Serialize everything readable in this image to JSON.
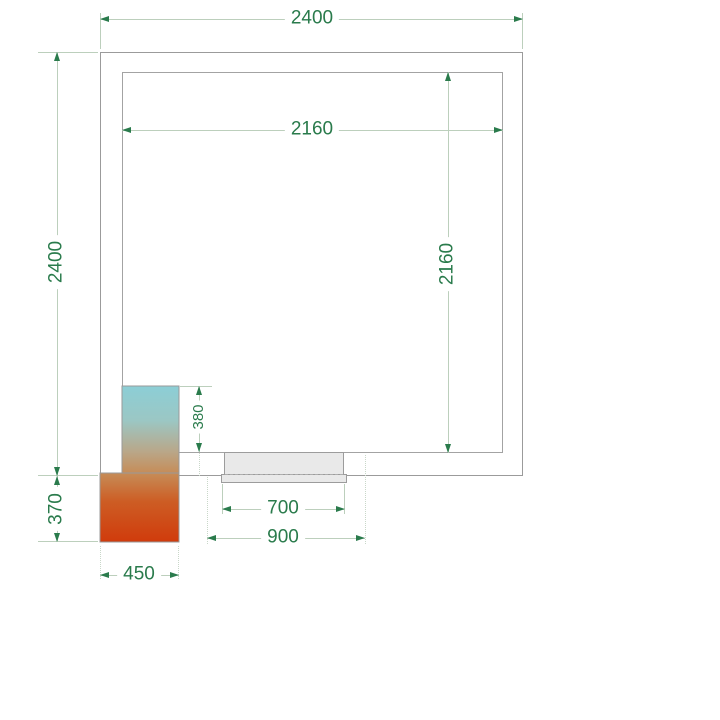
{
  "drawing": {
    "type": "cold-room-floor-plan",
    "dimensions": {
      "outer_width": "2400",
      "outer_depth": "2400",
      "inner_width": "2160",
      "inner_depth": "2160",
      "unit_inside_depth": "380",
      "unit_outside_depth": "370",
      "unit_width": "450",
      "door_clear_width": "700",
      "door_frame_width": "900"
    },
    "colors": {
      "dimension_text": "#2a7b4c",
      "dimension_line": "#bccfbc",
      "wall_line": "#9b9b9b",
      "door_fill": "#e9e9e9",
      "unit_gradient_top": "#8cced6",
      "unit_gradient_mid": "#c68c57",
      "unit_gradient_bottom": "#d03b0c"
    }
  }
}
